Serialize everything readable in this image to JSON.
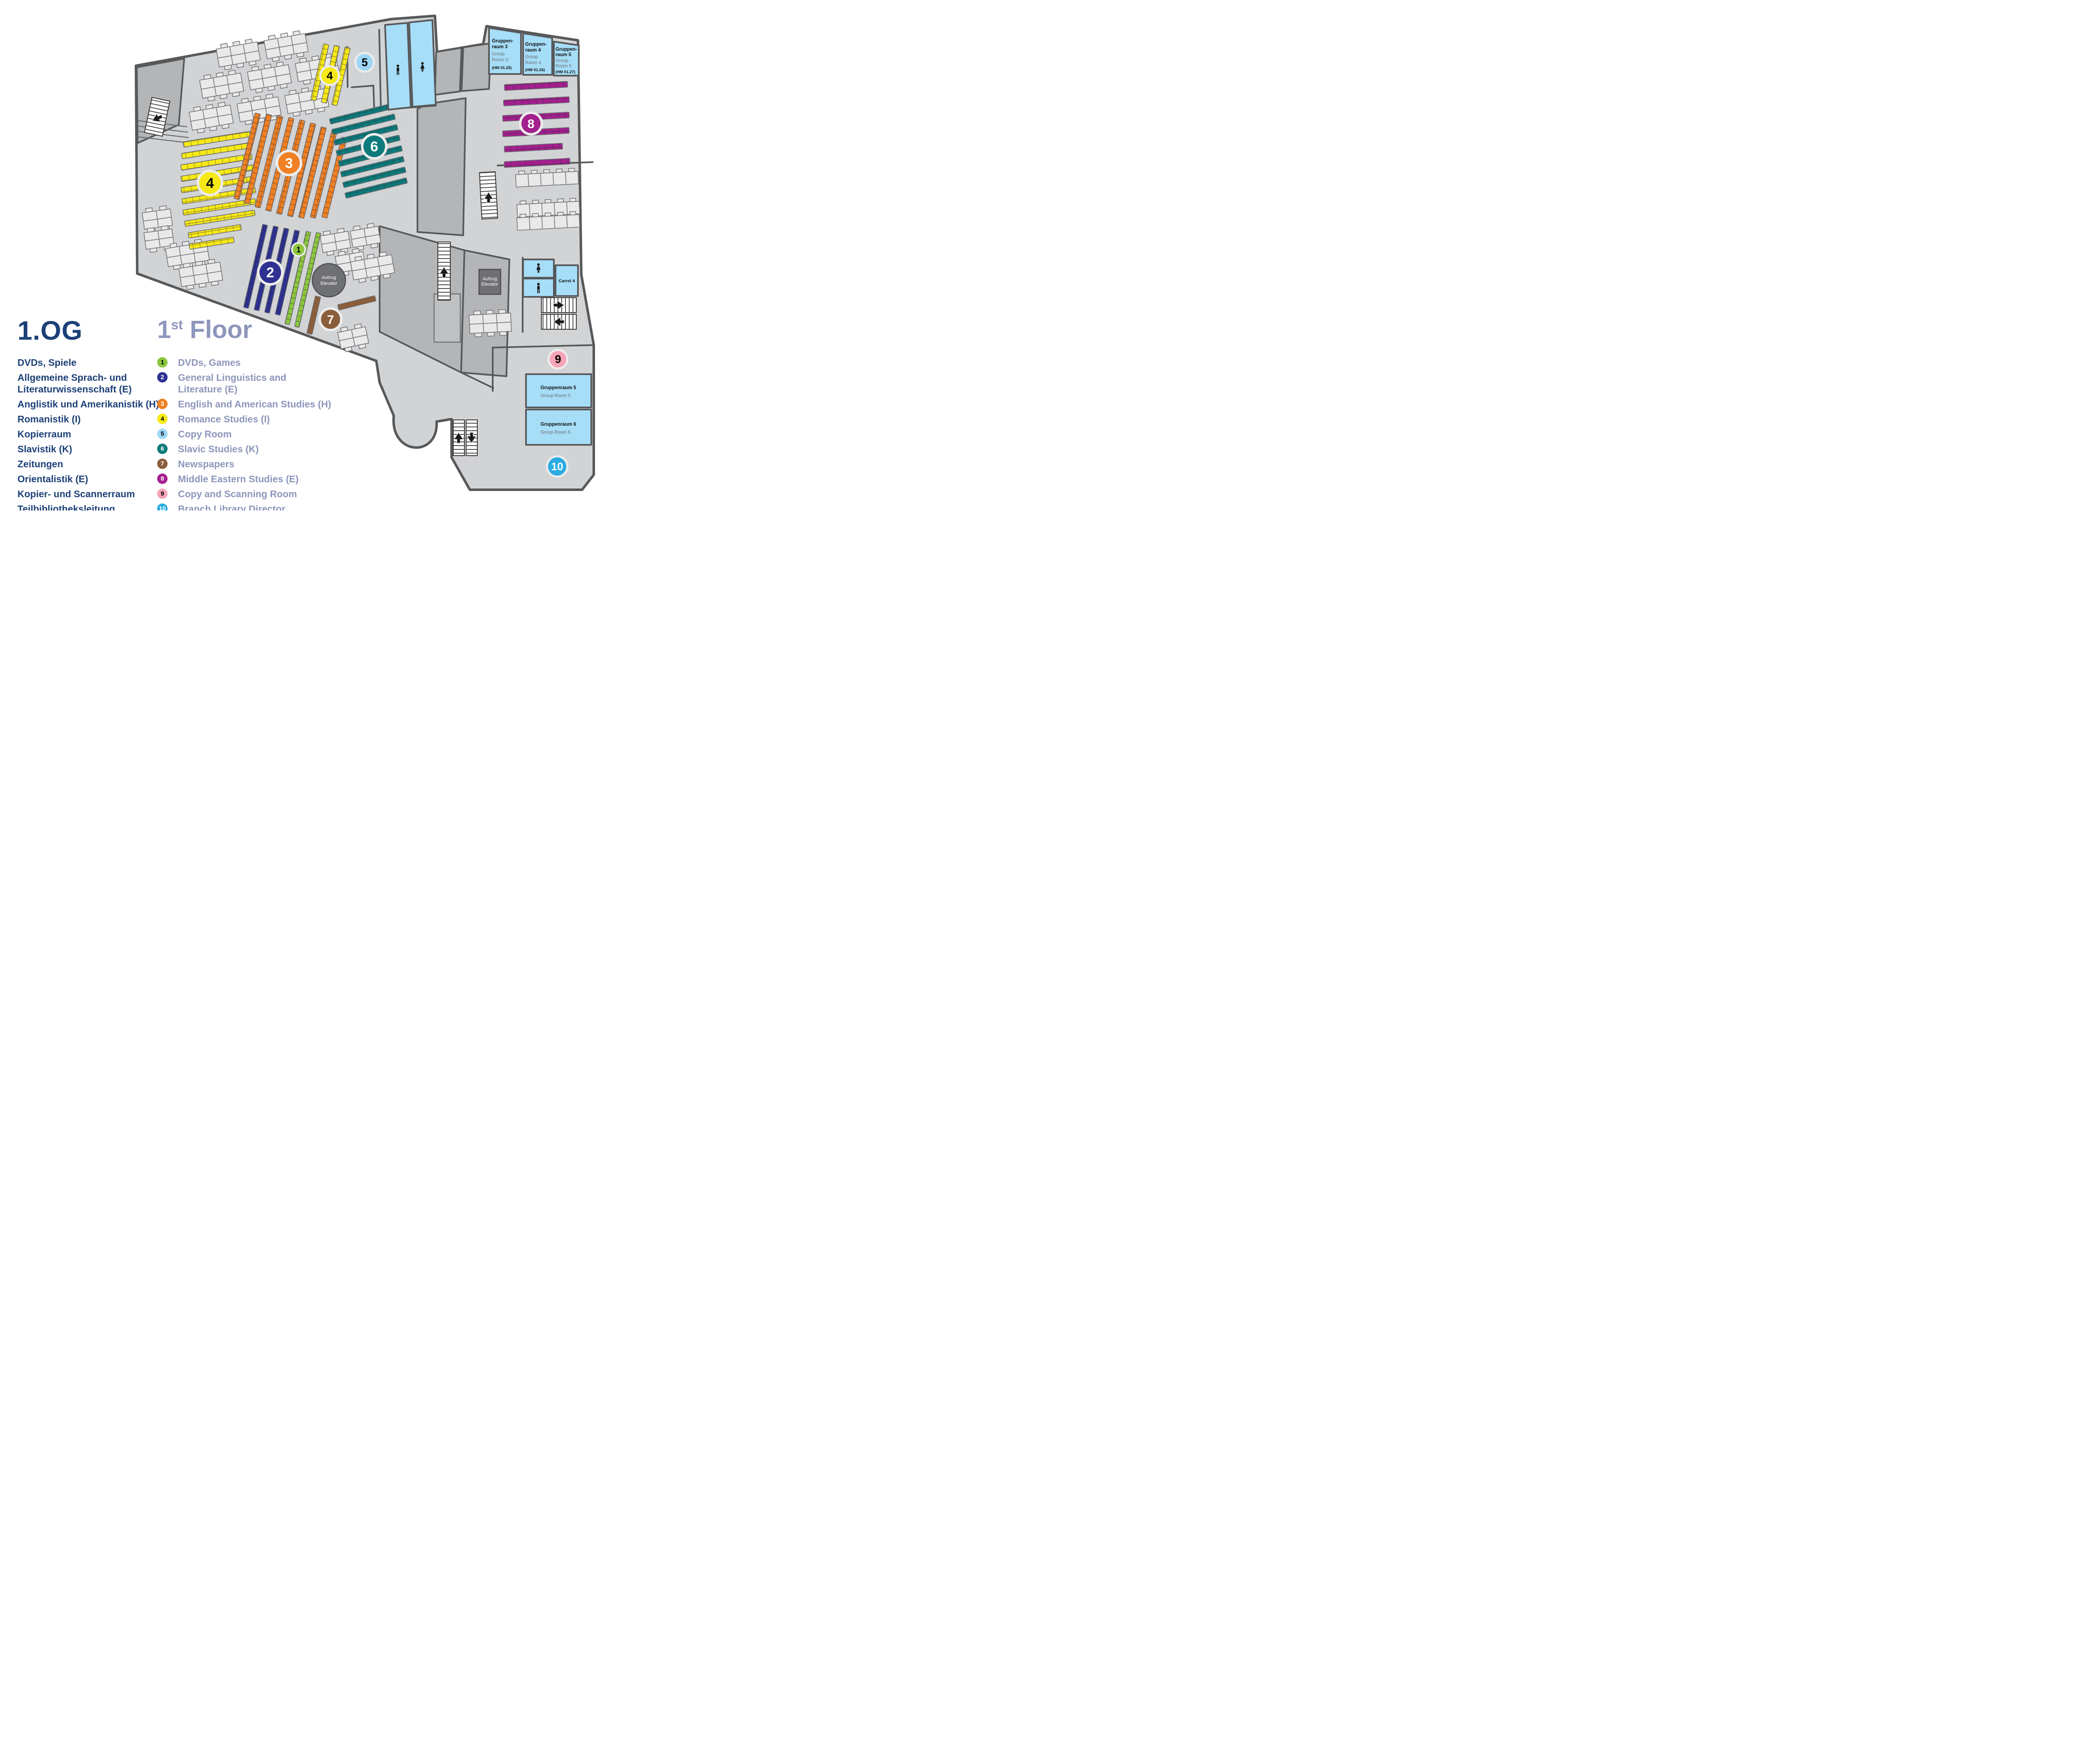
{
  "floor": {
    "title_de": "1.OG",
    "title_en_num": "1",
    "title_en_sup": "st",
    "title_en_word": "Floor"
  },
  "legend": [
    {
      "num": "1",
      "color": "#8dc63f",
      "num_color": "#000000",
      "de": "DVDs, Spiele",
      "de2": "",
      "en": "DVDs, Games",
      "en2": ""
    },
    {
      "num": "2",
      "color": "#2e3192",
      "num_color": "#ffffff",
      "de": "Allgemeine Sprach- und",
      "de2": "Literaturwissenschaft (E)",
      "en": "General Linguistics and",
      "en2": "Literature (E)"
    },
    {
      "num": "3",
      "color": "#f08023",
      "num_color": "#ffffff",
      "de": "Anglistik und Amerikanistik (H)",
      "de2": "",
      "en": "English and American Studies (H)",
      "en2": ""
    },
    {
      "num": "4",
      "color": "#f7e917",
      "num_color": "#000000",
      "de": "Romanistik (I)",
      "de2": "",
      "en": "Romance Studies (I)",
      "en2": ""
    },
    {
      "num": "5",
      "color": "#9ed7f6",
      "num_color": "#000000",
      "de": "Kopierraum",
      "de2": "",
      "en": "Copy Room",
      "en2": ""
    },
    {
      "num": "6",
      "color": "#0d7b7c",
      "num_color": "#ffffff",
      "de": "Slavistik (K)",
      "de2": "",
      "en": "Slavic Studies (K)",
      "en2": ""
    },
    {
      "num": "7",
      "color": "#8a5d3b",
      "num_color": "#ffffff",
      "de": "Zeitungen",
      "de2": "",
      "en": "Newspapers",
      "en2": ""
    },
    {
      "num": "8",
      "color": "#a3208f",
      "num_color": "#ffffff",
      "de": "Orientalistik (E)",
      "de2": "",
      "en": "Middle Eastern Studies (E)",
      "en2": ""
    },
    {
      "num": "9",
      "color": "#f7a3b8",
      "num_color": "#000000",
      "de": "Kopier- und Scannerraum",
      "de2": "",
      "en": "Copy and Scanning Room",
      "en2": ""
    },
    {
      "num": "10",
      "color": "#29abe2",
      "num_color": "#ffffff",
      "de": "Teilbibliotheksleitung",
      "de2": "",
      "en": "Branch Library Director",
      "en2": ""
    }
  ],
  "map": {
    "rooms": {
      "gr3": {
        "de1": "Gruppen-",
        "de2": "raum 3",
        "en1": "Group",
        "en2": "Room 3",
        "code": "(HM 01.25)"
      },
      "gr4": {
        "de1": "Gruppen-",
        "de2": "raum 4",
        "en1": "Group",
        "en2": "Room 4",
        "code": "(HM 01.26)"
      },
      "gr5": {
        "de1": "Gruppen-",
        "de2": "raum 5",
        "en1": "Group",
        "en2": "Room 5",
        "code": "(HM 01.27)"
      },
      "gr5b": {
        "de": "Gruppenraum 5",
        "en": "Group Room 5"
      },
      "gr6b": {
        "de": "Gruppenraum 6",
        "en": "Group Room 6"
      },
      "carrel": {
        "label": "Carrel 4"
      }
    },
    "elevator": {
      "de": "Aufzug",
      "en": "Elevator"
    },
    "icons": {
      "male": "male-figure-icon",
      "female": "female-figure-icon",
      "arrow": "direction-arrow-icon"
    }
  }
}
